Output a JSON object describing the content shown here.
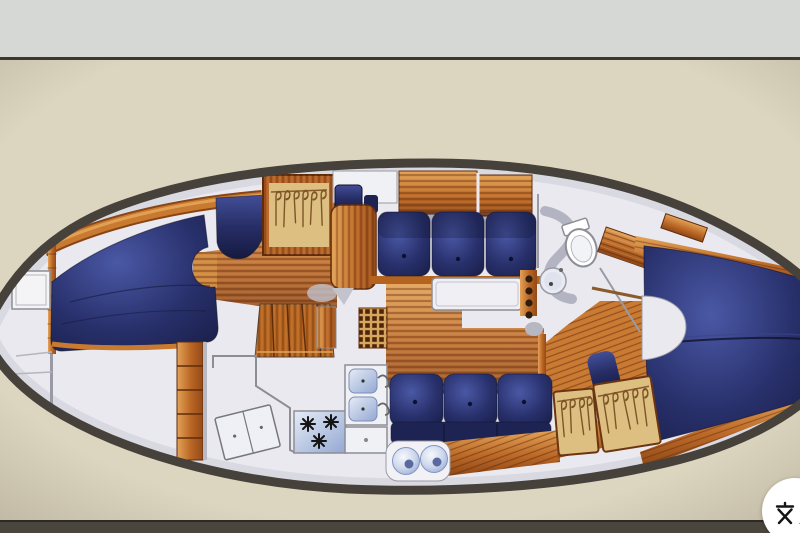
{
  "window": {
    "description": "photographed brochure page with sailboat interior floor plan, top view",
    "top_band": "light gray wall strip",
    "bottom_band": "dark table edge strip"
  },
  "colors": {
    "paper": "#dcd5bf",
    "paper-edge": "#c3bcab",
    "top-band": "#d6d8d5",
    "divider": "#3a382f",
    "bottom-bar": "#4a463d",
    "hull": "#46413a",
    "deck": "#eae9ef",
    "deck-shadow": "#c7c9d6",
    "line-gray": "#8d8d96",
    "navy": "#272e66",
    "navy-dark": "#10132e",
    "navy-light": "#424e97",
    "wood": "#c06a26",
    "wood-light": "#e3a257",
    "wood-dark": "#8f4716",
    "wood-line": "#5f2c0c",
    "tan": "#ddbf82",
    "hanger": "#7d5526",
    "appliance": "#b7c6e2",
    "counter": "#f0f1f5",
    "button-bg": "#ffffff",
    "button-fg": "#151515"
  },
  "floorplan": {
    "subject": "sailboat-interior-top-view",
    "regions": [
      "anchor-locker",
      "v-berth",
      "forward-hanging-locker",
      "fold-table",
      "companionway-steps",
      "sole-grate",
      "galley-stove",
      "galley-double-sink",
      "icebox",
      "bookshelf",
      "saloon-settee-port",
      "saloon-settee-starboard",
      "saloon-table",
      "head-toilet",
      "head-wash-basin",
      "aft-double-berth",
      "aft-hanging-lockers",
      "stereo-speakers"
    ]
  },
  "translate_button": {
    "icon": "translate-icon",
    "label": "文A",
    "letter": "A"
  }
}
